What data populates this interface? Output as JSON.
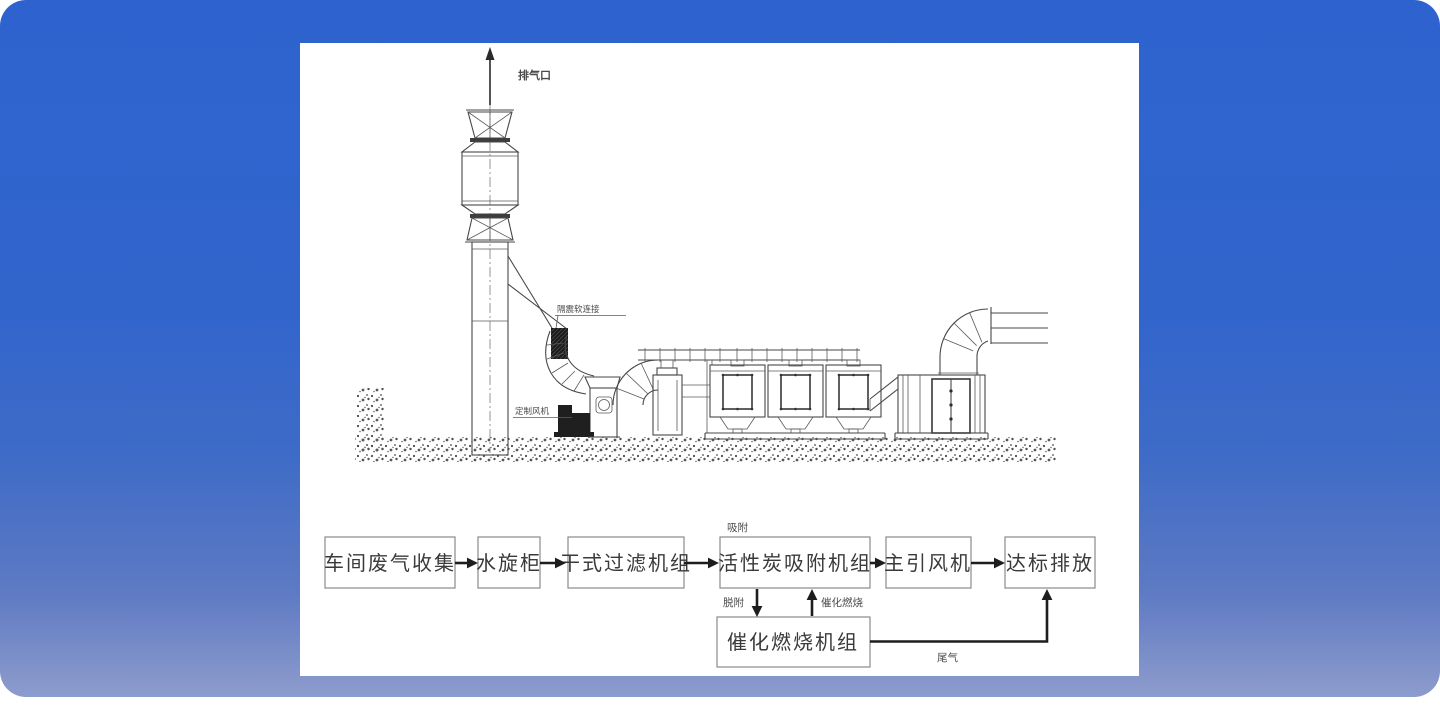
{
  "colors": {
    "background_top": "#2e63cf",
    "background_bottom": "#8d9cce",
    "panel": "#ffffff",
    "line": "#474747",
    "flow_border": "#8a8a8a",
    "flow_text": "#3a3a3a",
    "arrow": "#1d1d1d"
  },
  "drawing": {
    "labels": {
      "exhaust_outlet": "排气口",
      "flex_connector": "隔震软连接",
      "custom_fan": "定制风机"
    }
  },
  "flowchart": {
    "nodes": [
      {
        "label": "车间废气收集"
      },
      {
        "label": "水旋柜"
      },
      {
        "label": "干式过滤机组"
      },
      {
        "label": "活性炭吸附机组"
      },
      {
        "label": "主引风机"
      },
      {
        "label": "达标排放"
      },
      {
        "label": "催化燃烧机组"
      }
    ],
    "edge_labels": {
      "adsorption": "吸附",
      "desorption": "脱附",
      "catalytic_combustion": "催化燃烧",
      "tail_gas": "尾气"
    }
  }
}
